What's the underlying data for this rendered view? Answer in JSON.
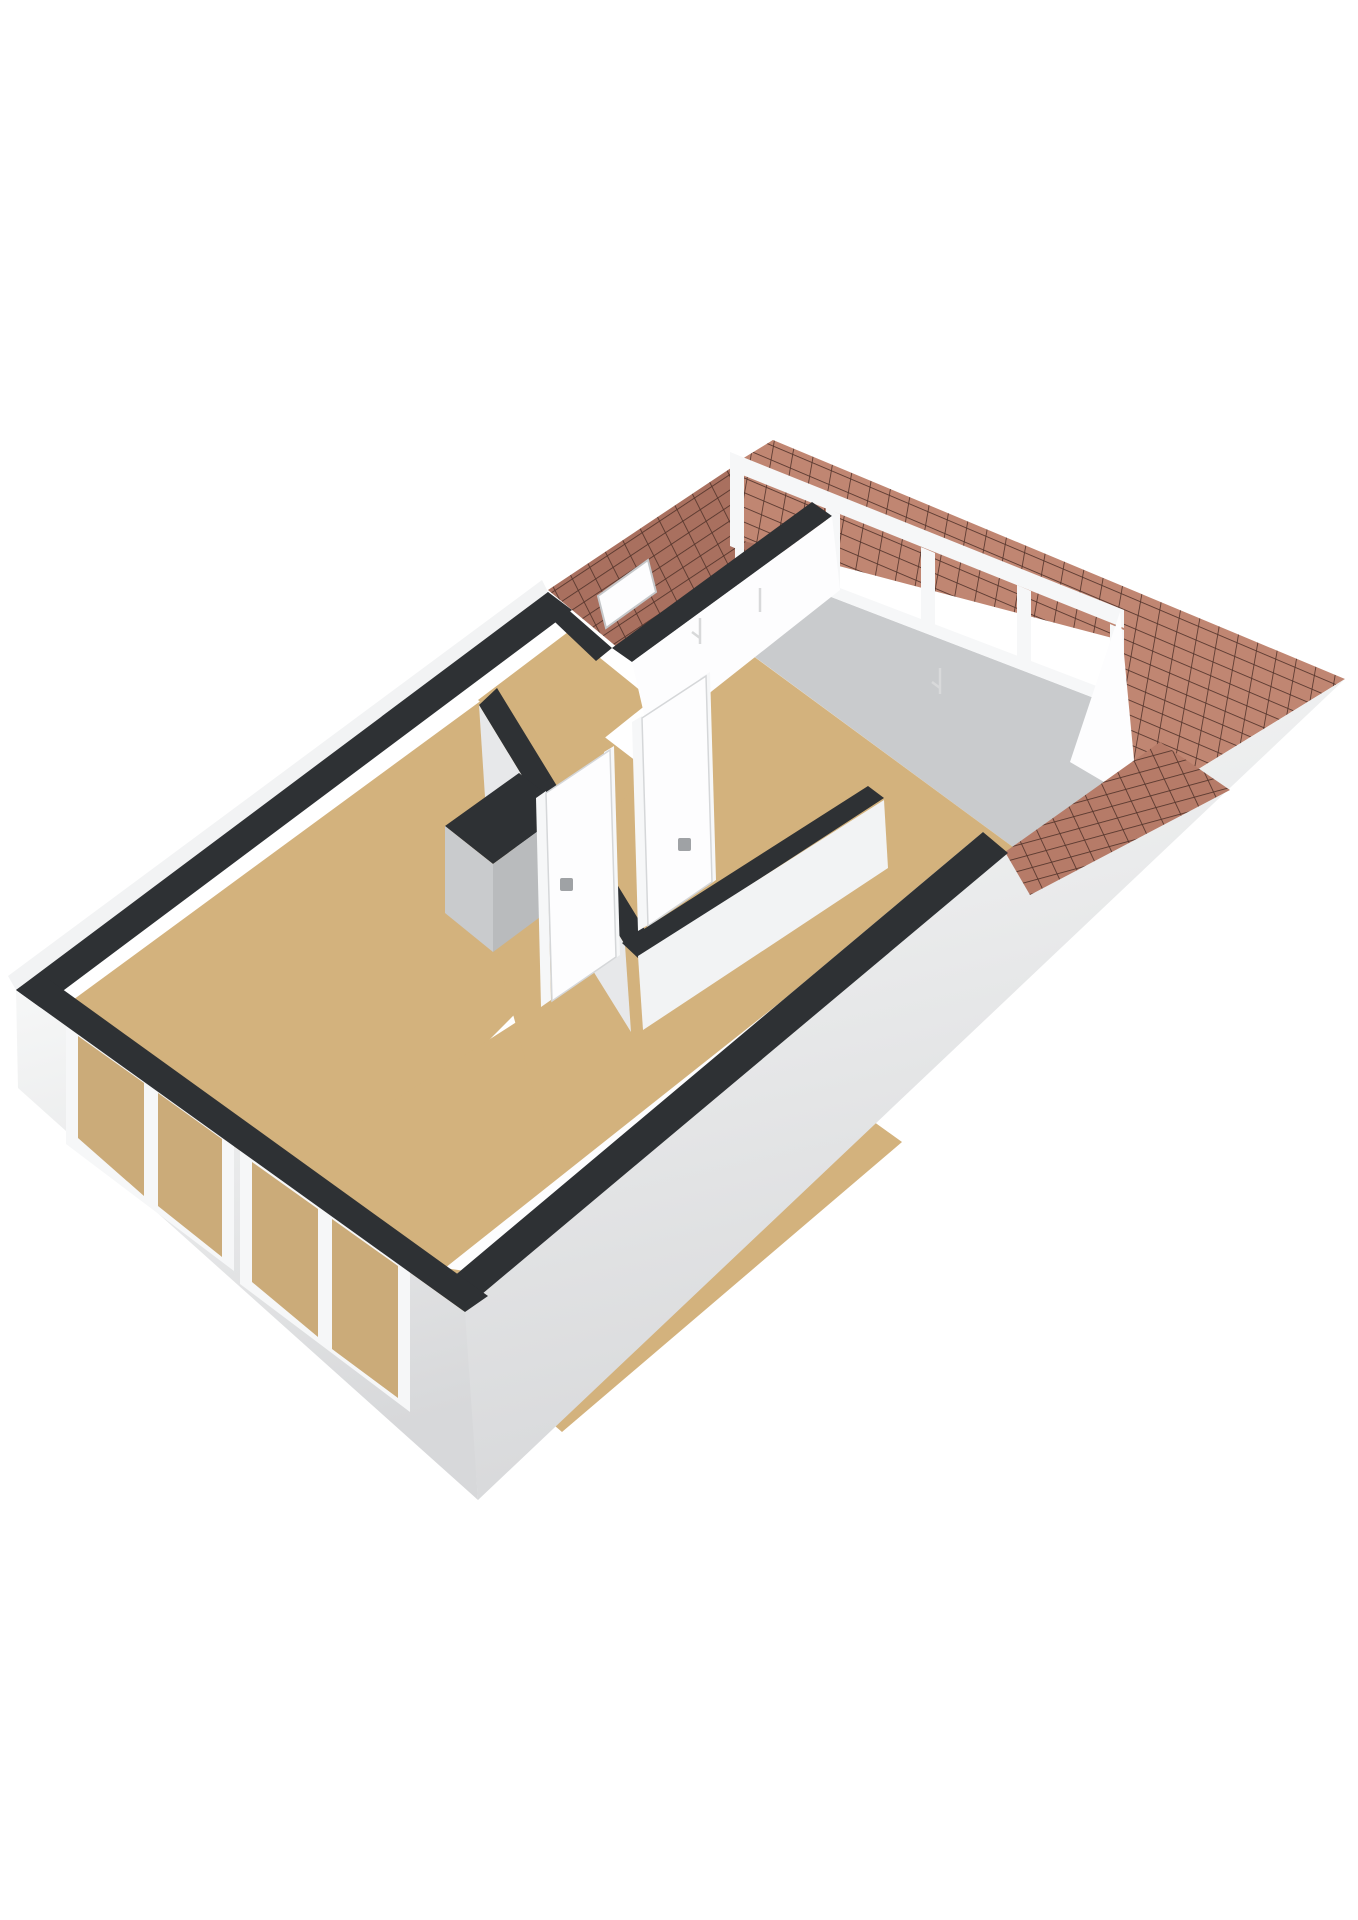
{
  "scene": {
    "kind": "3d-floorplan-birdseye-render",
    "background": "#ffffff",
    "rooms_visible": 4,
    "interior_doors": 2,
    "facade_window_groups": 2,
    "dormer_glass_panes": 4
  },
  "palette": {
    "background": "#ffffff",
    "floor": "#d3b27d",
    "floor_glass": "#cbab79",
    "wall_top_dark": "#2e3134",
    "wall_white": "#fdfdfe",
    "wall_white_dim": "#f2f3f4",
    "wall_gray_light": "#e7e8ea",
    "wall_gray_mid": "#c9cbcd",
    "wall_gray_deep": "#b9bbbd",
    "facade_base_top": "#f6f7f7",
    "facade_base_bottom": "#d7d8da",
    "frame_white": "#f6f7f8",
    "frame_shadow": "#dcdee0",
    "roof_ne": "#c08672",
    "roof_nw": "#a9705f",
    "roof_low": "#b67b68",
    "roof_line": "#55352c",
    "handle_gray": "#9fa2a5",
    "detail_line": "#d8d9da"
  }
}
